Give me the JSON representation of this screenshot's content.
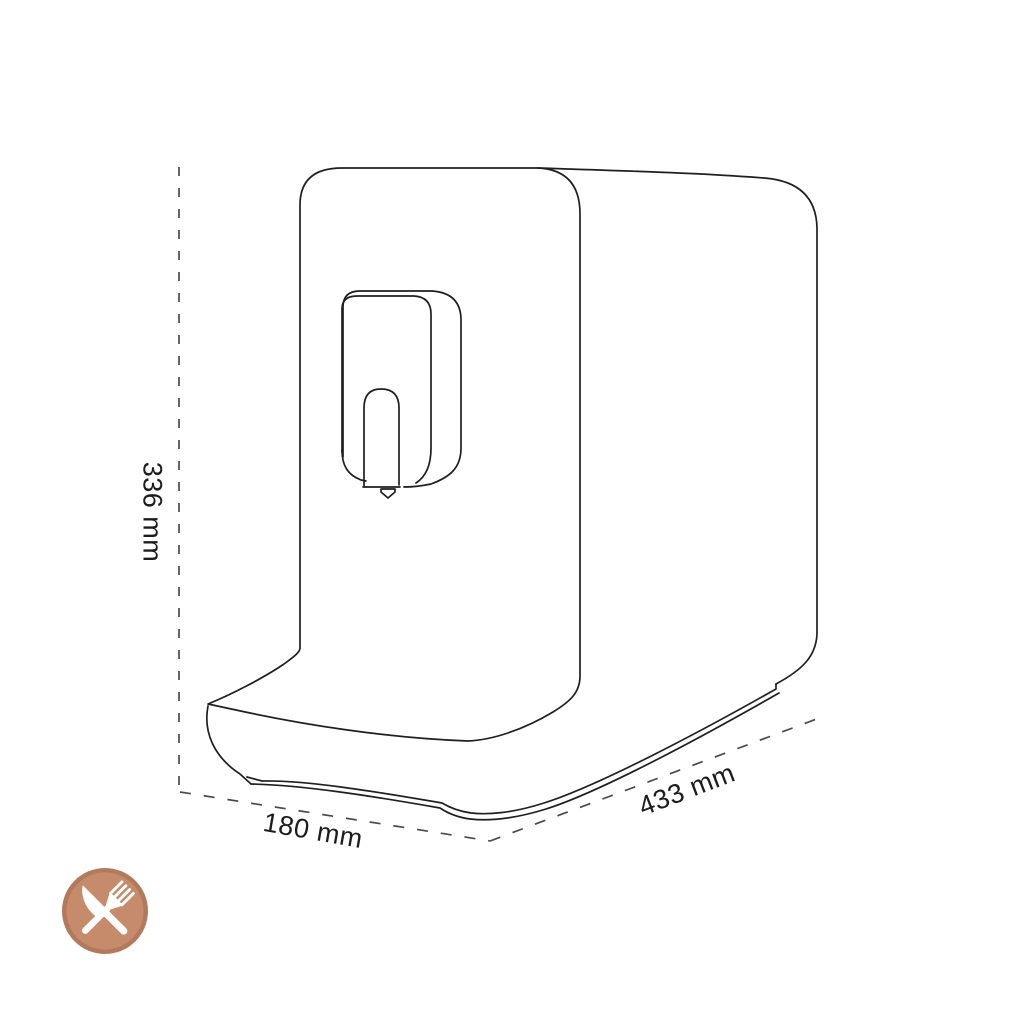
{
  "diagram": {
    "subject": "espresso-machine-outline-drawing",
    "line_color": "#1f1f1f",
    "dash_color": "#4a4a4a",
    "dimensions": {
      "height": {
        "label": "336 mm"
      },
      "depth": {
        "label": "180 mm"
      },
      "width": {
        "label": "433 mm"
      }
    }
  },
  "badge": {
    "icon": "fork-and-knife-icon",
    "colors": {
      "ring": "#b27a5b",
      "fill": "#c68b6b",
      "utensils": "#ffffff"
    }
  }
}
